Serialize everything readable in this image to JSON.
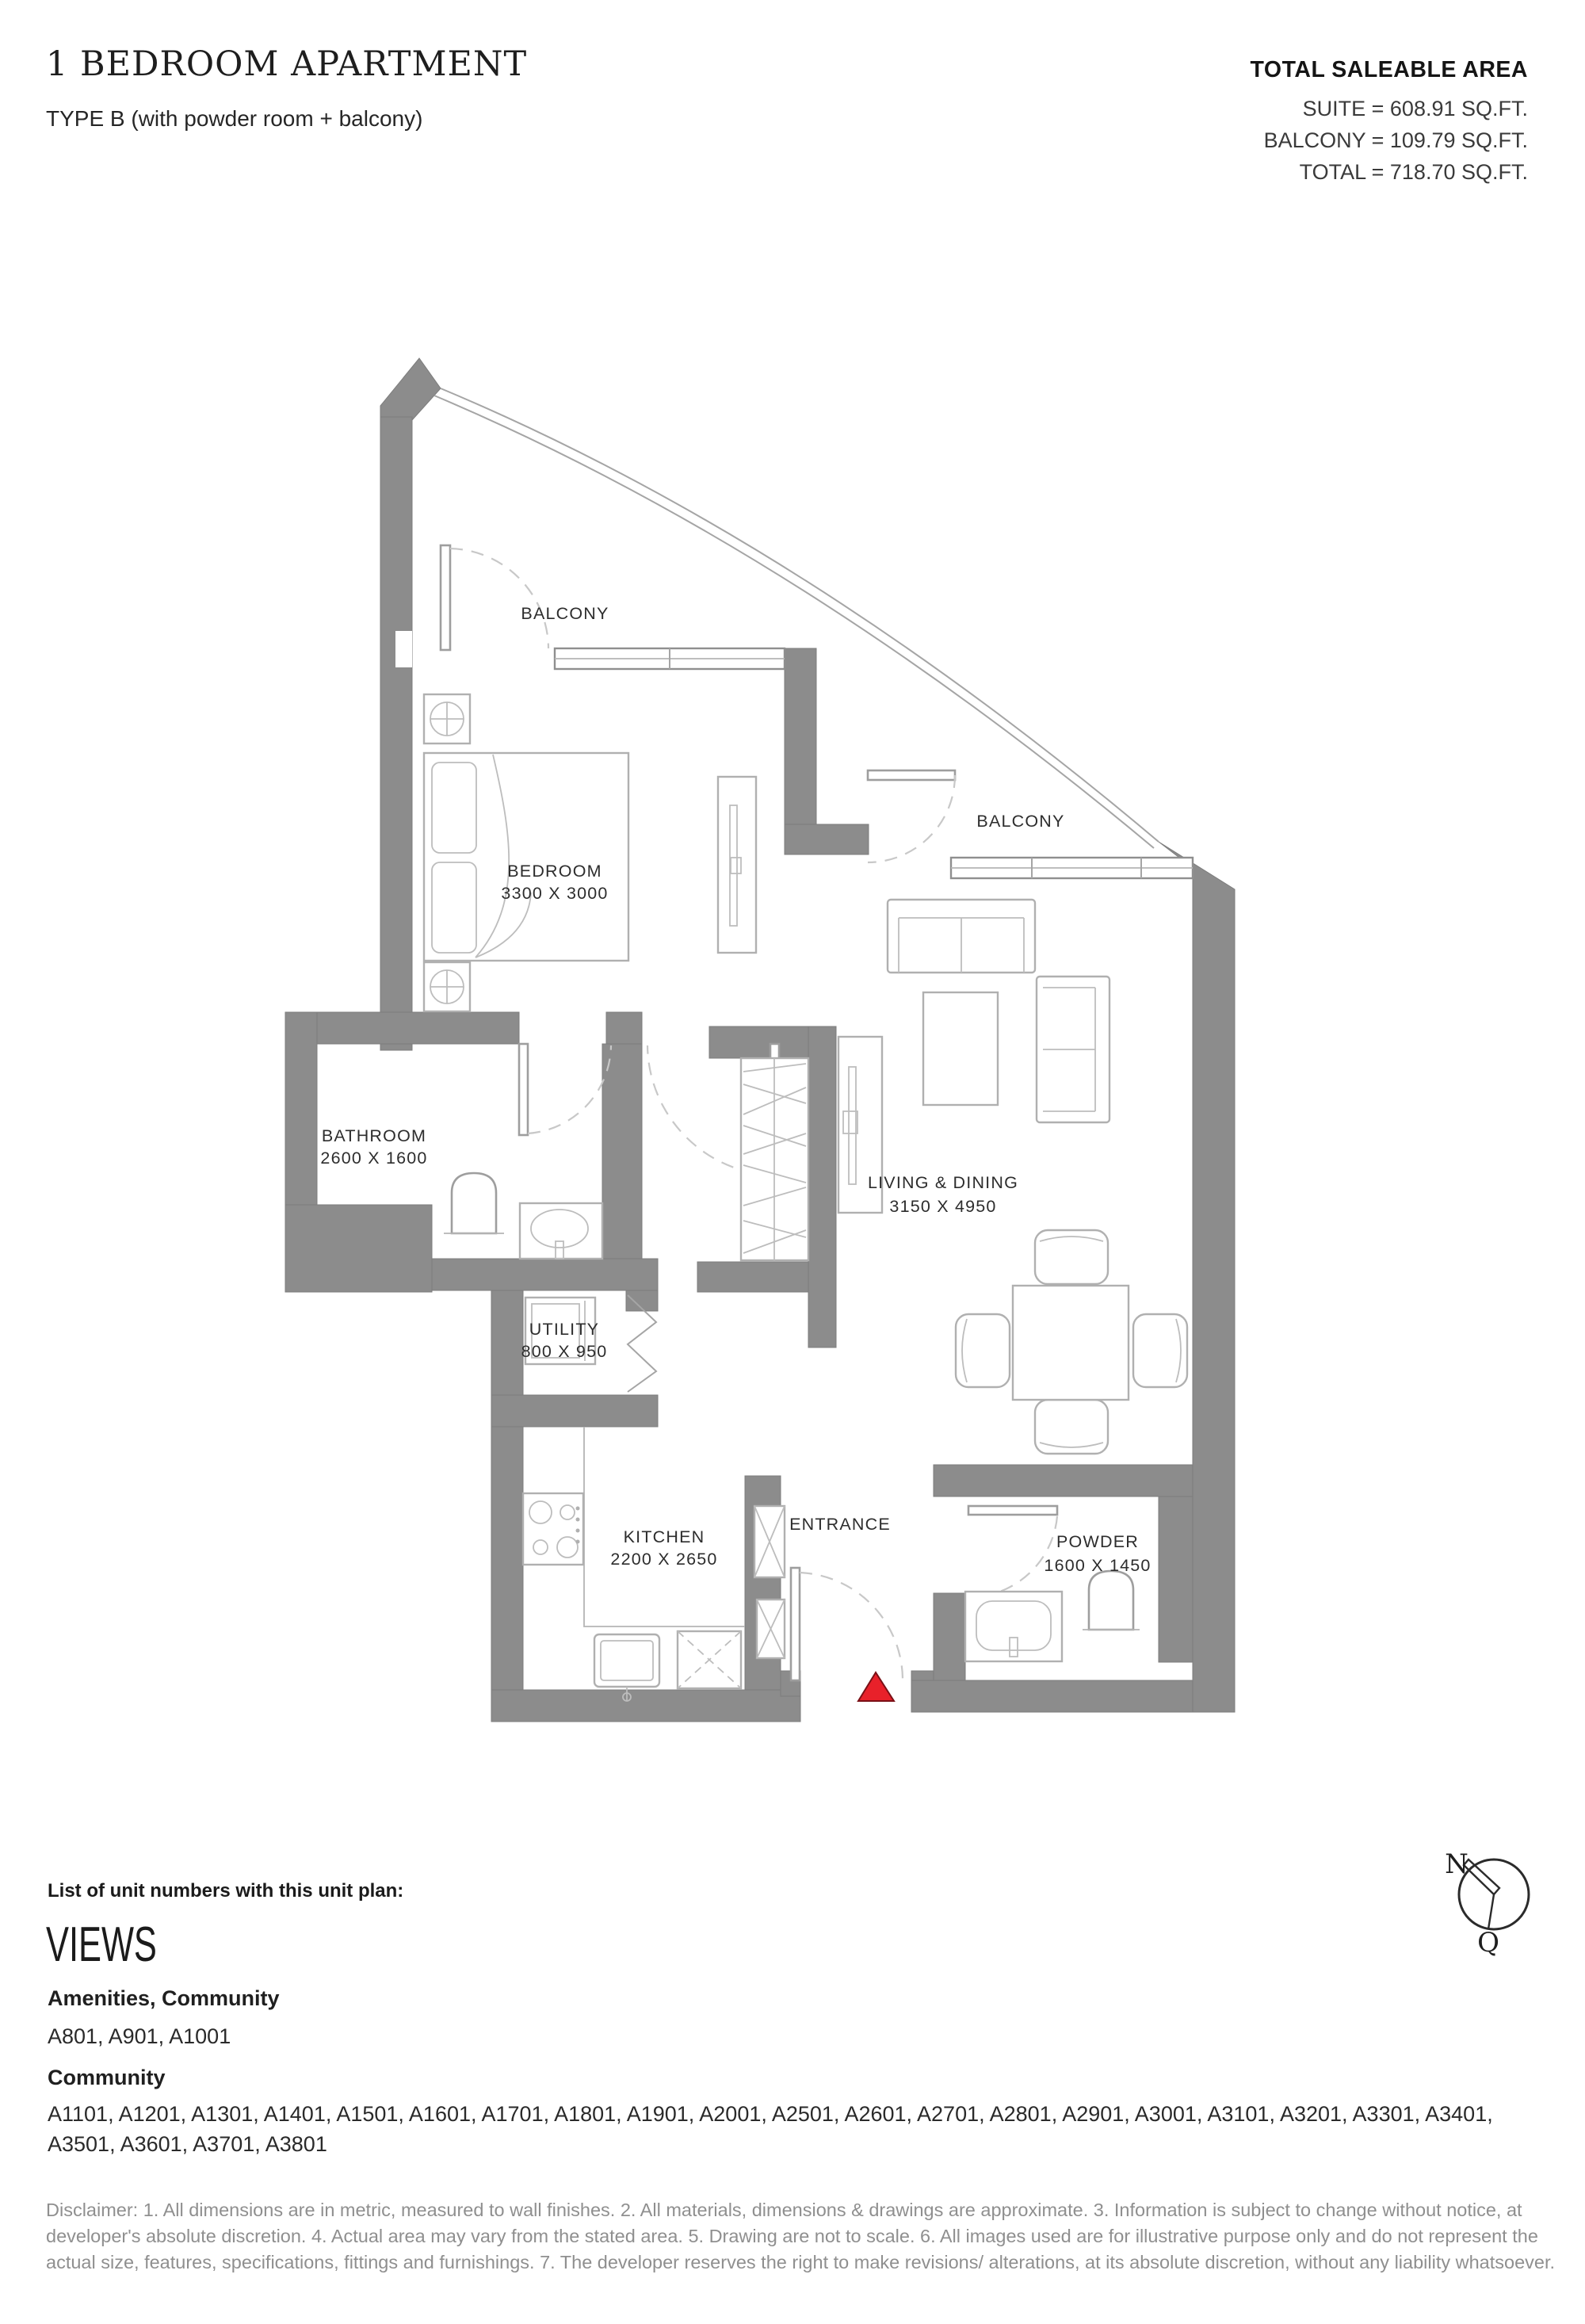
{
  "header": {
    "title": "1 BEDROOM APARTMENT",
    "subtitle": "TYPE B (with powder room + balcony)"
  },
  "area_summary": {
    "heading": "TOTAL SALEABLE AREA",
    "lines": [
      "SUITE = 608.91 SQ.FT.",
      "BALCONY = 109.79 SQ.FT.",
      "TOTAL = 718.70 SQ.FT."
    ]
  },
  "floor_plan": {
    "rooms": {
      "balcony_top": {
        "name": "BALCONY"
      },
      "balcony_right": {
        "name": "BALCONY"
      },
      "bedroom": {
        "name": "BEDROOM",
        "dimensions": "3300 X 3000"
      },
      "bathroom": {
        "name": "BATHROOM",
        "dimensions": "2600 X 1600"
      },
      "utility": {
        "name": "UTILITY",
        "dimensions": "800 X 950"
      },
      "living_dining": {
        "name": "LIVING & DINING",
        "dimensions": "3150 X 4950"
      },
      "kitchen": {
        "name": "KITCHEN",
        "dimensions": "2200 X 2650"
      },
      "entrance": {
        "name": "ENTRANCE"
      },
      "powder": {
        "name": "POWDER",
        "dimensions": "1600 X 1450"
      }
    },
    "colors": {
      "wall": "#8c8c8c",
      "entrance_marker": "#e8212a"
    }
  },
  "compass": {
    "north_label": "N",
    "south_label": "Q"
  },
  "unit_numbers": {
    "heading": "List of unit numbers with this unit plan:",
    "views_title": "VIEWS",
    "groups": [
      {
        "label": "Amenities, Community",
        "units": "A801, A901, A1001"
      },
      {
        "label": "Community",
        "units": "A1101, A1201, A1301, A1401, A1501, A1601, A1701, A1801, A1901, A2001, A2501, A2601, A2701, A2801, A2901, A3001, A3101, A3201, A3301, A3401, A3501, A3601, A3701, A3801"
      }
    ]
  },
  "disclaimer": "Disclaimer: 1. All dimensions are in metric, measured to wall finishes. 2. All materials, dimensions & drawings are approximate. 3. Information is subject to change without notice, at developer's absolute discretion. 4. Actual area may vary from the stated area. 5. Drawing are not to scale. 6. All images used are for illustrative purpose only and do not represent the actual size, features, specifications, fittings and furnishings. 7. The developer reserves the right to make revisions/ alterations, at its absolute discretion, without any liability whatsoever."
}
